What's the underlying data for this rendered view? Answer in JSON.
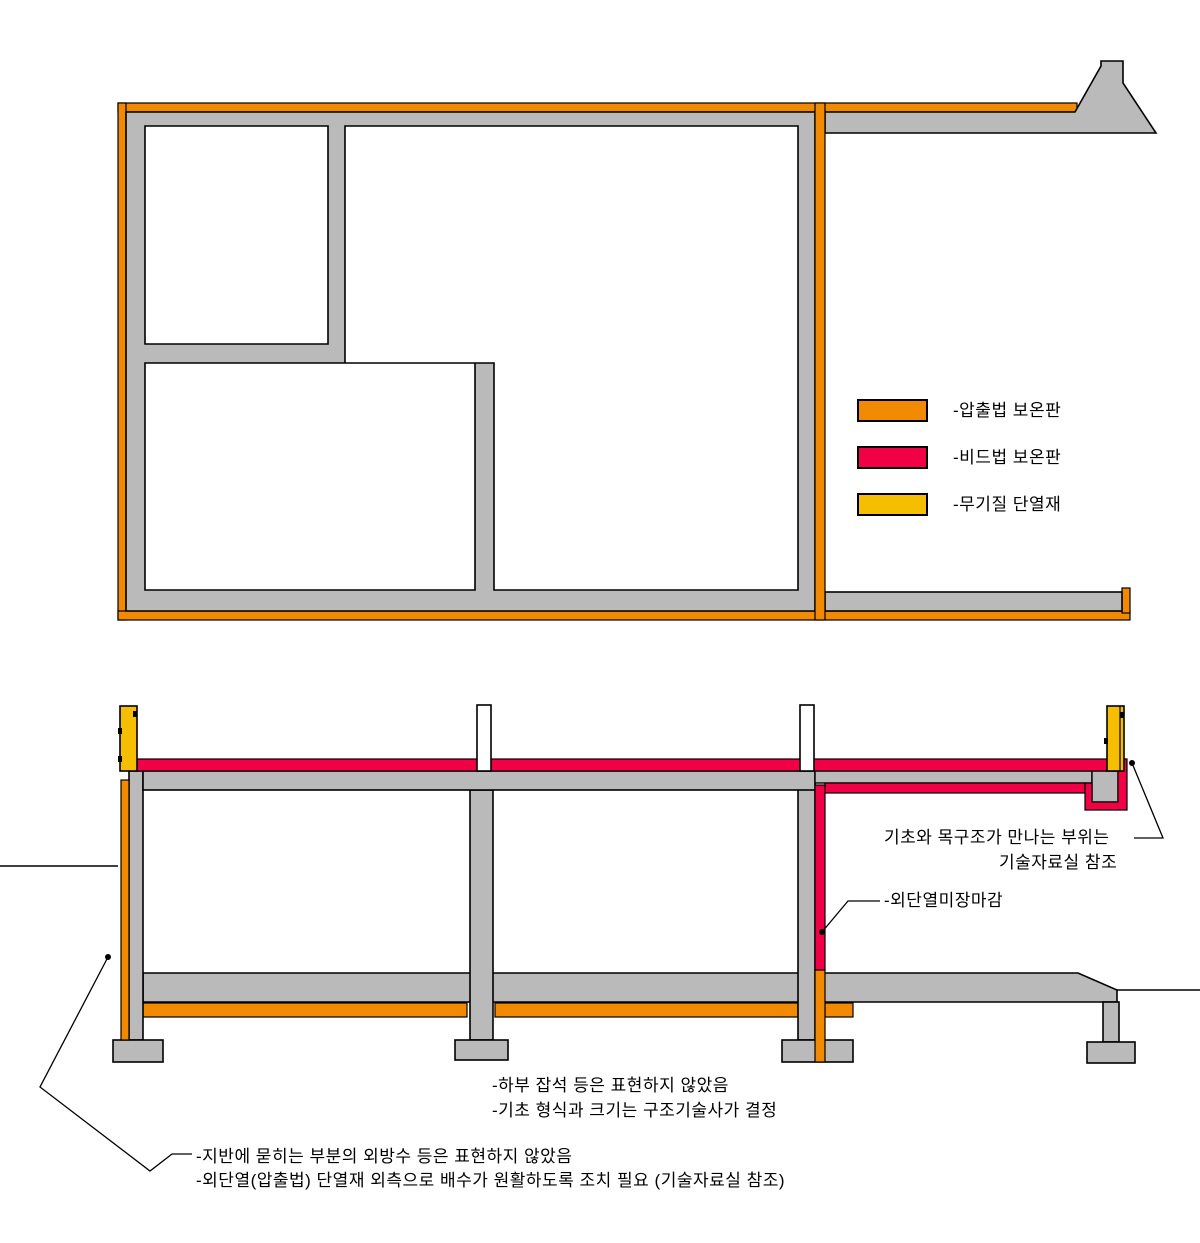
{
  "colors": {
    "extruded": "#F18A00",
    "bead": "#F10045",
    "mineral": "#F5BE00",
    "wall": "#BABABA",
    "line": "#000000",
    "bg": "#FFFFFF"
  },
  "legend": {
    "items": [
      {
        "id": "extruded-insulation",
        "label": "-압출법 보온판"
      },
      {
        "id": "bead-insulation",
        "label": "-비드법 보온판"
      },
      {
        "id": "mineral-insulation",
        "label": "-무기질 단열재"
      }
    ]
  },
  "annotations": {
    "foundation_wood_line1": "기초와 목구조가 만나는 부위는",
    "foundation_wood_line2": "기술자료실 참조",
    "exterior_finish": "-외단열미장마감",
    "note_rubble": "-하부 잡석 등은 표현하지 않았음",
    "note_foundation_size": "-기초 형식과 크기는 구조기술사가 결정",
    "note_waterproofing": "-지반에 묻히는 부분의 외방수 등은 표현하지 않았음",
    "note_drainage": "-외단열(압출법) 단열재 외측으로 배수가 원활하도록 조치 필요 (기술자료실 참조)"
  }
}
